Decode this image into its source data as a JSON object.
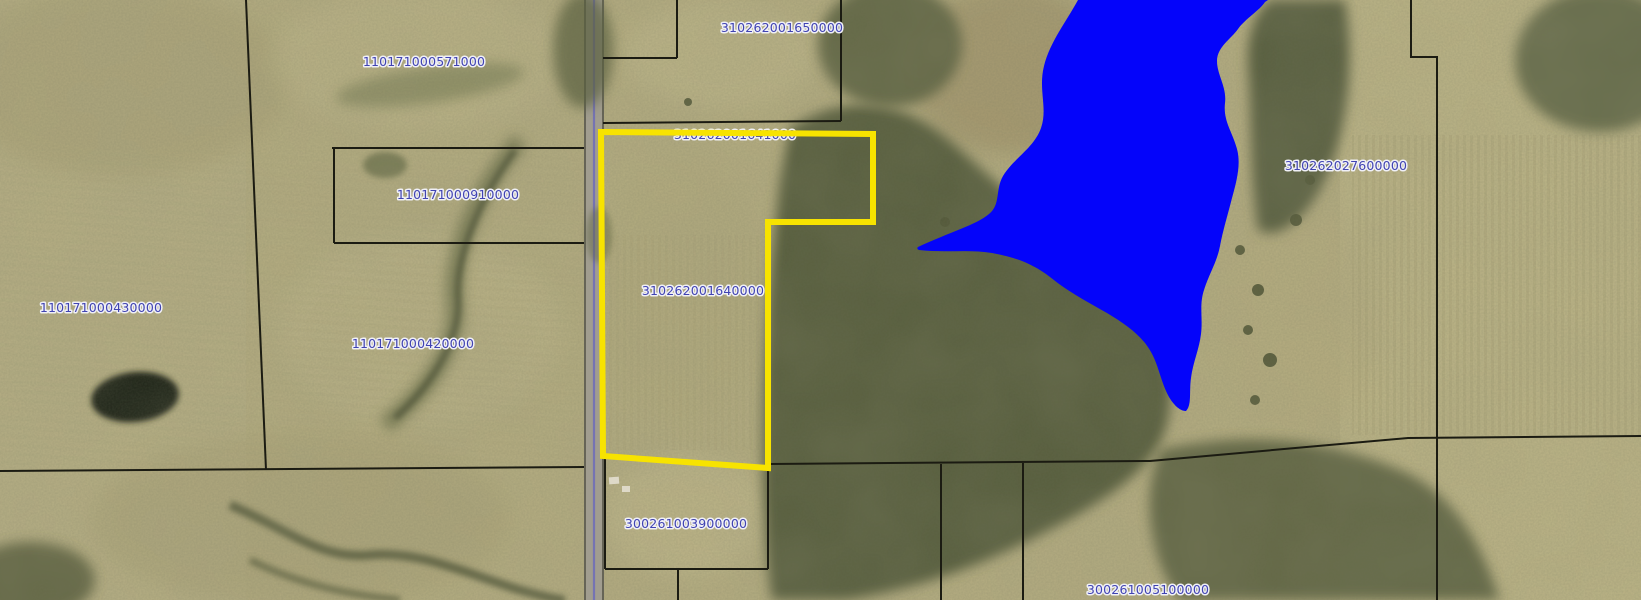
{
  "app": {
    "view_name": "aerial-parcel-map",
    "basemap": "aerial-imagery"
  },
  "map": {
    "parcels": [
      {
        "id": "110171000571000"
      },
      {
        "id": "310262001650000"
      },
      {
        "id": "310262001641000"
      },
      {
        "id": "110171000910000"
      },
      {
        "id": "110171000430000"
      },
      {
        "id": "310262001640000"
      },
      {
        "id": "110171000420000"
      },
      {
        "id": "310262027600000"
      },
      {
        "id": "300261003900000"
      },
      {
        "id": "300261005100000"
      }
    ],
    "selection": {
      "highlighted_parcel_id": "310262001640000",
      "outline_color": "#f7e300"
    },
    "water": {
      "feature": "lake",
      "lake_color": "#0404fa"
    },
    "road": {
      "centerline_color": "#5252d2"
    },
    "labels": {
      "text_color": "#4043b2",
      "halo_color": "#f0f0f6"
    },
    "lines": {
      "parcel_line_color": "#1b1b12"
    }
  }
}
